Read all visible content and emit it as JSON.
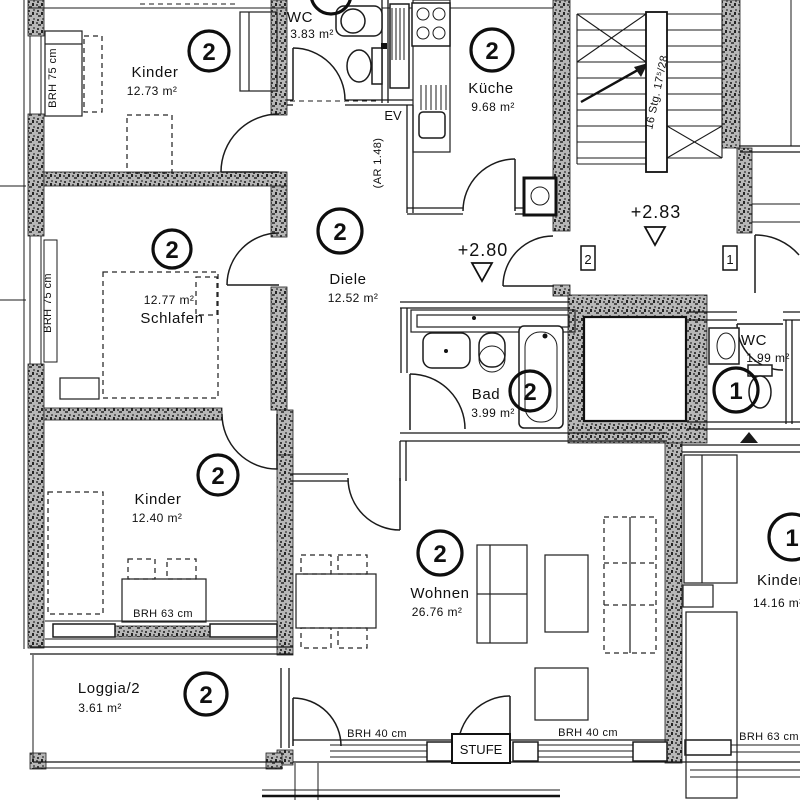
{
  "rooms": {
    "kinder_top": {
      "name": "Kinder",
      "area": "12.73 m²",
      "tag": "2"
    },
    "wc_2": {
      "name": "WC",
      "area": "3.83 m²",
      "tag": "2"
    },
    "kueche": {
      "name": "Küche",
      "area": "9.68 m²",
      "tag": "2"
    },
    "diele": {
      "name": "Diele",
      "area": "12.52 m²",
      "tag": "2"
    },
    "schlafen": {
      "name": "Schlafen",
      "area": "12.77 m²",
      "tag": "2"
    },
    "bad": {
      "name": "Bad",
      "area": "3.99 m²",
      "tag": "2"
    },
    "wc_1": {
      "name": "WC",
      "area": "1.99 m²",
      "tag": "1"
    },
    "kinder_bottom": {
      "name": "Kinder",
      "area": "12.40 m²",
      "tag": "2"
    },
    "wohnen": {
      "name": "Wohnen",
      "area": "26.76 m²",
      "tag": "2"
    },
    "kinder_right": {
      "name": "Kinder",
      "area": "14.16 m²",
      "tag": "1"
    },
    "loggia": {
      "name": "Loggia/2",
      "area": "3.61 m²",
      "tag": "2"
    }
  },
  "annotations": {
    "parapet_top_left": "BRH 75 cm",
    "parapet_mid_left": "BRH 75 cm",
    "parapet_kinder_bottom": "BRH 63 cm",
    "parapet_wohnen_left": "BRH 40 cm",
    "parapet_wohnen_right": "BRH 40 cm",
    "parapet_right": "BRH 63 cm",
    "step_label": "STUFE",
    "ev_label": "EV",
    "niche_label": "(AR 1.48)",
    "stair_label": "16 Stg. 17⁵/28",
    "level_stairs": "+2.83",
    "level_hall": "+2.80",
    "apt_tag_2": "2",
    "apt_tag_1": "1"
  }
}
